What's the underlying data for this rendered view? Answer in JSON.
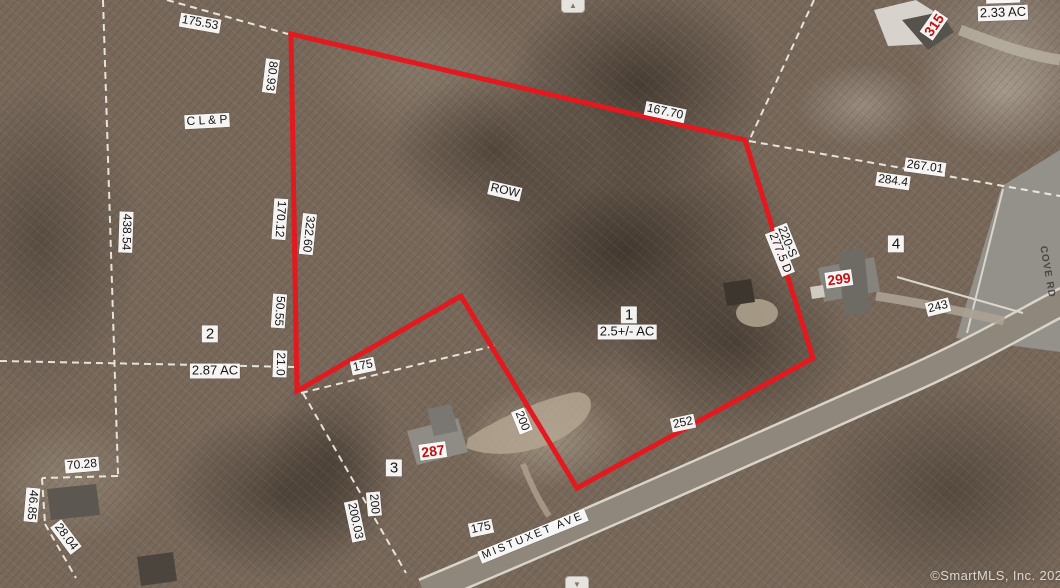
{
  "attribution": "©SmartMLS, Inc. 2021",
  "controls": {
    "pan_up_icon": "▲",
    "pan_down_icon": "▼"
  },
  "colors": {
    "boundary_red": "#e4181f",
    "house_number_red": "#c31111",
    "parcel_line_white": "#f4f1ea"
  },
  "subject_parcel": {
    "lot": "1",
    "area": "2.5+/- AC",
    "easement": "ROW"
  },
  "streets": [
    {
      "name": "MISTUXET AVE"
    },
    {
      "name": "COVE RD"
    }
  ],
  "labels": [
    {
      "name": "dim-175-53",
      "text": "175.53",
      "x": 200,
      "y": 23,
      "rot": 10,
      "kind": "dim"
    },
    {
      "name": "dim-80-93",
      "text": "80.93",
      "x": 271,
      "y": 76,
      "rot": 97,
      "kind": "dim"
    },
    {
      "name": "utility-label-clp",
      "text": "C L & P",
      "x": 207,
      "y": 121,
      "rot": -3,
      "kind": "dim"
    },
    {
      "name": "dim-167-70",
      "text": "167.70",
      "x": 665,
      "y": 112,
      "rot": 12,
      "kind": "dim"
    },
    {
      "name": "house-number-315",
      "text": "315",
      "x": 934,
      "y": 25,
      "rot": -55,
      "kind": "red"
    },
    {
      "name": "dim-partial-top",
      "text": "335.4",
      "x": 1003,
      "y": -4,
      "rot": -2,
      "kind": "dim"
    },
    {
      "name": "area-2-33-ac",
      "text": "2.33 AC",
      "x": 1003,
      "y": 13,
      "rot": -2,
      "kind": "area"
    },
    {
      "name": "dim-267-01",
      "text": "267.01",
      "x": 925,
      "y": 167,
      "rot": 8,
      "kind": "dim"
    },
    {
      "name": "dim-284-4",
      "text": "284.4",
      "x": 893,
      "y": 181,
      "rot": 8,
      "kind": "dim"
    },
    {
      "name": "lot-number-4",
      "text": "4",
      "x": 896,
      "y": 244,
      "rot": 0,
      "kind": "lot"
    },
    {
      "name": "dim-220-s",
      "text": "220-S",
      "x": 787,
      "y": 242,
      "rot": 68,
      "kind": "dim"
    },
    {
      "name": "dim-277-5-d",
      "text": "277.5 D",
      "x": 780,
      "y": 253,
      "rot": 68,
      "kind": "dim"
    },
    {
      "name": "house-number-299",
      "text": "299",
      "x": 839,
      "y": 279,
      "rot": -8,
      "kind": "red"
    },
    {
      "name": "dim-243",
      "text": "243",
      "x": 938,
      "y": 307,
      "rot": -14,
      "kind": "dim"
    },
    {
      "name": "row-easement-label",
      "text": "ROW",
      "x": 505,
      "y": 191,
      "rot": 13,
      "kind": "dim"
    },
    {
      "name": "lot-number-1",
      "text": "1",
      "x": 629,
      "y": 315,
      "rot": 0,
      "kind": "lot"
    },
    {
      "name": "area-2-5-ac",
      "text": "2.5+/- AC",
      "x": 627,
      "y": 332,
      "rot": 0,
      "kind": "area"
    },
    {
      "name": "dim-438-54",
      "text": "438.54",
      "x": 126,
      "y": 232,
      "rot": 92,
      "kind": "dim"
    },
    {
      "name": "dim-170-12",
      "text": "170.12",
      "x": 280,
      "y": 219,
      "rot": 94,
      "kind": "dim"
    },
    {
      "name": "dim-322-60",
      "text": "322.60",
      "x": 308,
      "y": 234,
      "rot": 96,
      "kind": "dim"
    },
    {
      "name": "dim-50-55",
      "text": "50.55",
      "x": 279,
      "y": 311,
      "rot": 94,
      "kind": "dim"
    },
    {
      "name": "lot-number-2",
      "text": "2",
      "x": 210,
      "y": 334,
      "rot": 0,
      "kind": "lot"
    },
    {
      "name": "area-2-87-ac",
      "text": "2.87 AC",
      "x": 215,
      "y": 371,
      "rot": 0,
      "kind": "area"
    },
    {
      "name": "dim-21-0",
      "text": "21.0",
      "x": 280,
      "y": 364,
      "rot": 92,
      "kind": "dim"
    },
    {
      "name": "dim-70-28",
      "text": "70.28",
      "x": 82,
      "y": 465,
      "rot": -5,
      "kind": "dim"
    },
    {
      "name": "dim-46-85",
      "text": "46.85",
      "x": 32,
      "y": 505,
      "rot": 95,
      "kind": "dim"
    },
    {
      "name": "dim-28-04",
      "text": "28.04",
      "x": 66,
      "y": 537,
      "rot": 53,
      "kind": "dim"
    },
    {
      "name": "dim-175-upper",
      "text": "175",
      "x": 363,
      "y": 366,
      "rot": -12,
      "kind": "dim"
    },
    {
      "name": "dim-200-right",
      "text": "200",
      "x": 522,
      "y": 421,
      "rot": 68,
      "kind": "dim"
    },
    {
      "name": "house-number-287",
      "text": "287",
      "x": 433,
      "y": 451,
      "rot": -8,
      "kind": "red"
    },
    {
      "name": "lot-number-3",
      "text": "3",
      "x": 394,
      "y": 468,
      "rot": 0,
      "kind": "lot"
    },
    {
      "name": "dim-200-left",
      "text": "200",
      "x": 374,
      "y": 504,
      "rot": 85,
      "kind": "dim"
    },
    {
      "name": "dim-200-03",
      "text": "200.03",
      "x": 355,
      "y": 521,
      "rot": 78,
      "kind": "dim"
    },
    {
      "name": "dim-175-lower",
      "text": "175",
      "x": 481,
      "y": 528,
      "rot": -12,
      "kind": "dim"
    },
    {
      "name": "street-mistuxet-ave",
      "text": "MISTUXET AVE",
      "x": 533,
      "y": 536,
      "rot": -22,
      "kind": "street"
    },
    {
      "name": "dim-252",
      "text": "252",
      "x": 683,
      "y": 423,
      "rot": -12,
      "kind": "dim"
    },
    {
      "name": "street-cove-rd",
      "text": "COVE RD",
      "x": 1047,
      "y": 272,
      "rot": 80,
      "kind": "roadname"
    }
  ]
}
